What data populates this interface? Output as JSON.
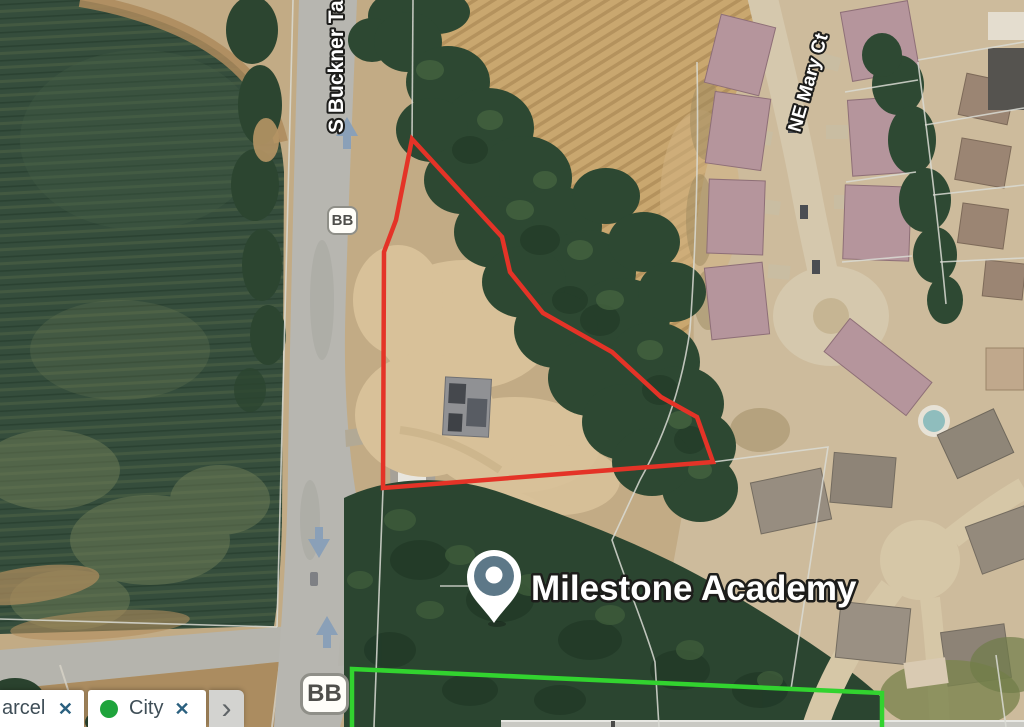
{
  "map": {
    "labels": {
      "road_vertical": "S Buckner Ta",
      "road_court": "NE Mary Ct",
      "place": "Milestone Academy"
    },
    "badges": {
      "top": "BB",
      "bottom": "BB"
    }
  },
  "filter_bar": {
    "chips": [
      {
        "label": "arcel",
        "close_icon": "✕"
      },
      {
        "label": "City",
        "close_icon": "✕"
      }
    ],
    "expand_icon": "›"
  },
  "colors": {
    "selection_red": "#e43327",
    "selection_green": "#32d32f",
    "close_icon_blue": "#2b607f",
    "city_dot_green": "#1fa43c",
    "direction_arrow": "#8aa0b8",
    "pin_fill": "#5d7888"
  }
}
